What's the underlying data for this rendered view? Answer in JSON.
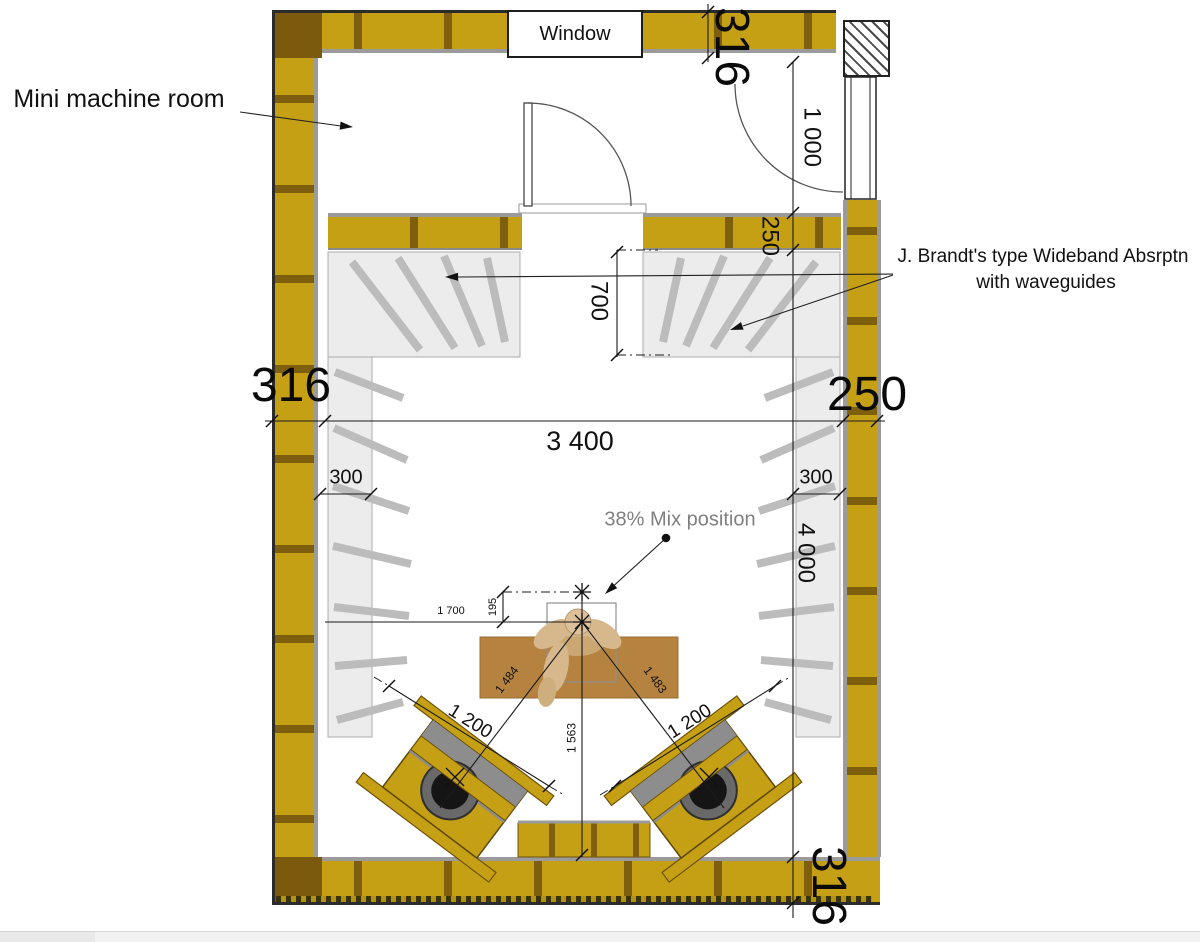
{
  "labels": {
    "machine_room": "Mini machine room",
    "window": "Window",
    "mix_position": "38% Mix position",
    "absorber_note_line1": "J. Brandt's type Wideband Absrptn",
    "absorber_note_line2": "with waveguides"
  },
  "dimensions": {
    "top_wall_thickness": "316",
    "machine_room_depth": "1 000",
    "inner_wall_thickness": "250",
    "front_absorber_depth": "700",
    "left_wall_thickness": "316",
    "right_wall_thickness": "250",
    "room_width": "3 400",
    "left_absorber_depth": "300",
    "right_absorber_depth": "300",
    "room_length": "4 000",
    "listener_offset": "195",
    "listener_from_left": "1 700",
    "left_speaker_to_mix": "1 484",
    "right_speaker_to_mix": "1 483",
    "left_speaker_span": "1 200",
    "right_speaker_span": "1 200",
    "mix_to_rear_wall": "1 563",
    "bottom_wall_thickness": "316"
  },
  "colors": {
    "wall_brick": "#c5a014",
    "wall_corner": "#7b5a0e",
    "mortar": "#7e5f0e",
    "lining_gray": "#9b9b9b",
    "absorber_panel": "#ececec",
    "waveguide_fin": "#bcbcbc",
    "desk": "#b5823f",
    "figure": "#d7b88c",
    "dimension_text": "#111111",
    "annotation_gray": "#808080"
  }
}
